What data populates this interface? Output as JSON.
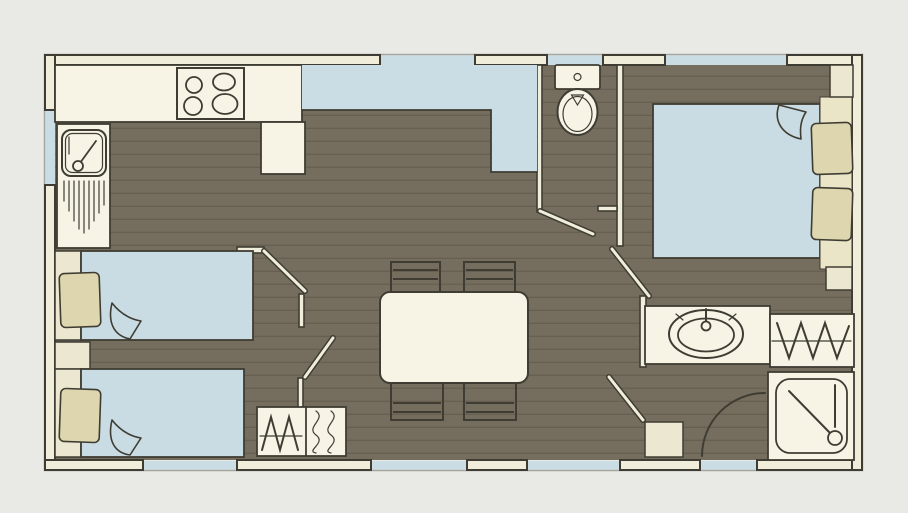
{
  "colors": {
    "background": "#e9e9e6",
    "floor": "#756e5e",
    "plank_line": "#675f4f",
    "wall_fill": "#f0edda",
    "outline": "#3f3d33",
    "window_blue": "#cbdde4",
    "furniture_cream": "#f7f4e6",
    "soft_cream": "#ece7d0",
    "pillow_khaki": "#ddd6ae",
    "bed_blue": "#c9dce3",
    "headboard_cream": "#ebe5c8",
    "outer_line": "#a3a79f"
  },
  "plan": {
    "type": "mobile-home floor plan",
    "rooms": {
      "kitchen": {
        "label": "Kitchen"
      },
      "lounge_dining": {
        "label": "Lounge and dining area"
      },
      "twin_bedroom": {
        "label": "Twin bedroom"
      },
      "double_bedroom": {
        "label": "Double bedroom"
      },
      "wc": {
        "label": "WC"
      },
      "shower_room": {
        "label": "Shower room"
      }
    },
    "furniture": {
      "hob": {
        "label": "Hob with 4 burners"
      },
      "kitchen_sink": {
        "label": "Kitchen sink with drainer"
      },
      "worktop": {
        "label": "Kitchen worktop"
      },
      "fridge": {
        "label": "Fridge unit"
      },
      "lounge_seating": {
        "label": "L-shaped lounge seating"
      },
      "dining_table": {
        "label": "Dining table"
      },
      "dining_chairs": {
        "label": "4 dining chairs"
      },
      "single_beds": {
        "label": "2 single beds"
      },
      "double_bed": {
        "label": "Double bed"
      },
      "toilet": {
        "label": "Toilet"
      },
      "washbasin": {
        "label": "Washbasin vanity"
      },
      "shower": {
        "label": "Shower cubicle"
      },
      "wardrobes": {
        "label": "Wardrobes"
      },
      "nightstands": {
        "label": "Bedside tables"
      }
    }
  }
}
